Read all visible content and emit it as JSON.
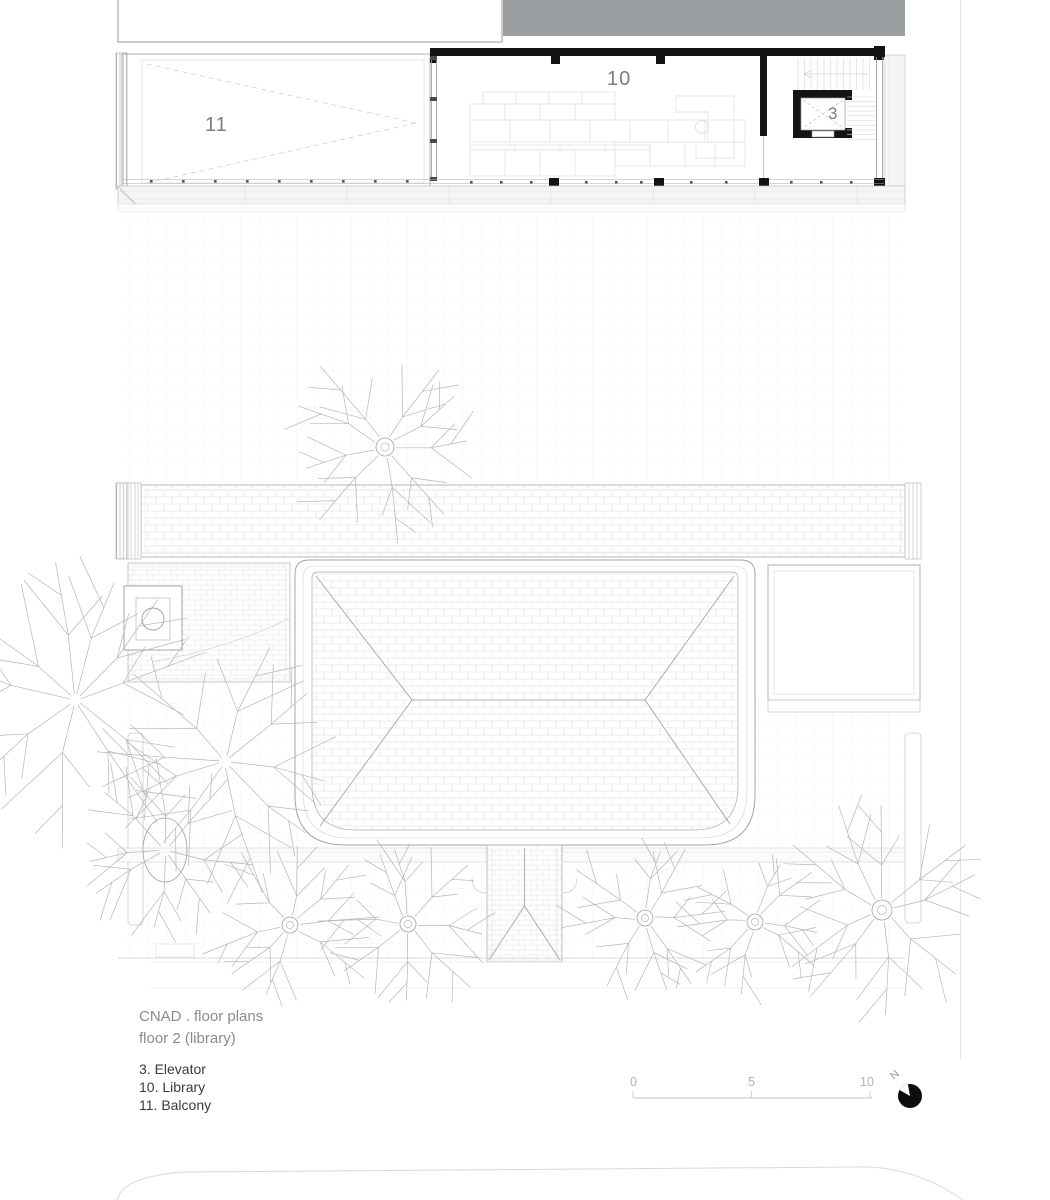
{
  "title_block": {
    "line1": "CNAD . floor plans",
    "line2": "floor 2 (library)"
  },
  "legend": {
    "items": [
      "3. Elevator",
      "10. Library",
      "11. Balcony"
    ]
  },
  "room_labels": {
    "balcony": "11",
    "library": "10",
    "elevator": "3"
  },
  "scale_bar": {
    "tick0": "0",
    "tick1": "5",
    "tick2": "10"
  },
  "north_arrow": {
    "label": "N"
  },
  "colors": {
    "header_block": "#9b9ea1",
    "walls": "#141414",
    "hatch_line": "#dcdcdc",
    "text_muted": "#8b8b8b",
    "text_dark": "#3b3b3b",
    "tree_line": "#b6b6b6"
  },
  "plan": {
    "trees": [
      {
        "x": 385,
        "y": 447,
        "r": 95,
        "branches": 9,
        "trunk": 9,
        "seed": 11
      },
      {
        "x": 75,
        "y": 700,
        "r": 140,
        "branches": 10,
        "trunk": 0,
        "seed": 22
      },
      {
        "x": 225,
        "y": 762,
        "r": 125,
        "branches": 9,
        "trunk": 0,
        "seed": 33
      },
      {
        "x": 165,
        "y": 850,
        "r": 95,
        "branches": 8,
        "trunk": 0,
        "seed": 44,
        "ellipse": [
          22,
          32
        ]
      },
      {
        "x": 290,
        "y": 925,
        "r": 85,
        "branches": 8,
        "trunk": 8,
        "seed": 55
      },
      {
        "x": 408,
        "y": 924,
        "r": 85,
        "branches": 8,
        "trunk": 8,
        "seed": 66
      },
      {
        "x": 645,
        "y": 918,
        "r": 80,
        "branches": 8,
        "trunk": 8,
        "seed": 77
      },
      {
        "x": 755,
        "y": 922,
        "r": 76,
        "branches": 8,
        "trunk": 8,
        "seed": 88
      },
      {
        "x": 882,
        "y": 910,
        "r": 105,
        "branches": 9,
        "trunk": 10,
        "seed": 99
      }
    ]
  }
}
